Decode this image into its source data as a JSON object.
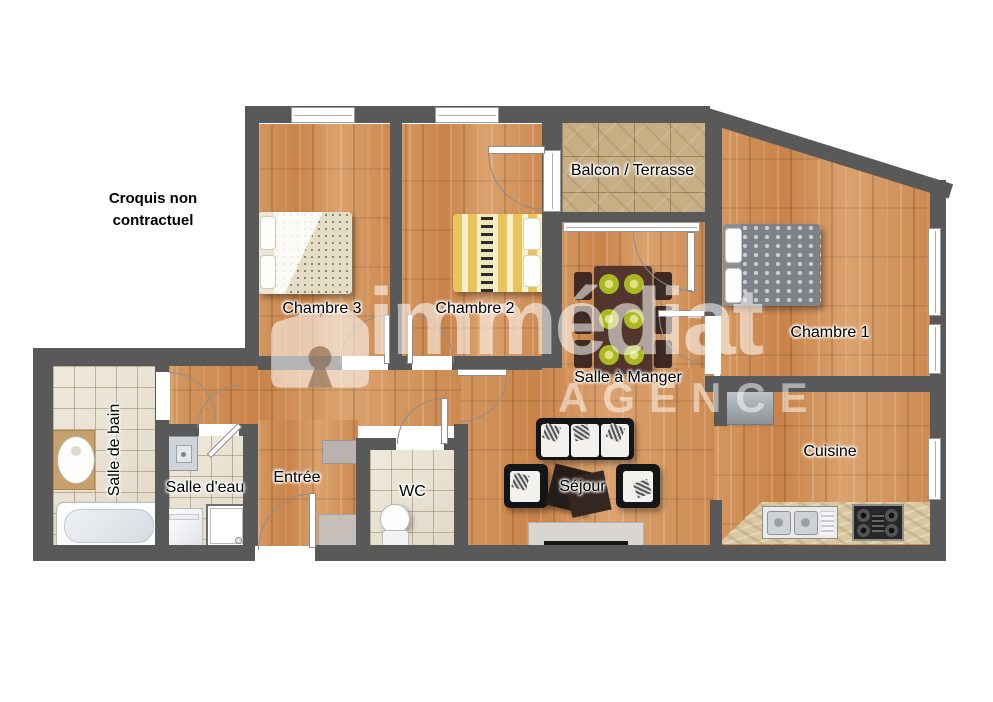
{
  "disclaimer": {
    "line1": "Croquis non",
    "line2": "contractuel"
  },
  "watermark": {
    "brand": "immédiat",
    "subtitle": "AGENCE"
  },
  "rooms": {
    "balcon": "Balcon / Terrasse",
    "chambre1": "Chambre 1",
    "chambre2": "Chambre 2",
    "chambre3": "Chambre 3",
    "salle_a_manger": "Salle à Manger",
    "cuisine": "Cuisine",
    "sejour": "Séjour",
    "entree": "Entrée",
    "wc": "WC",
    "salle_eau": "Salle d'eau",
    "salle_de_bain": "Salle de bain"
  },
  "colors": {
    "wall": "#595959",
    "wood_floor": "#cf8f56",
    "bathroom_tile": "#eae2d0",
    "balcony_tile": "#c7ae85",
    "counter_stone": "#d9c79f",
    "plate_green": "#b5c42e",
    "label_text": "#000000",
    "watermark": "rgba(255,255,255,0.55)"
  }
}
